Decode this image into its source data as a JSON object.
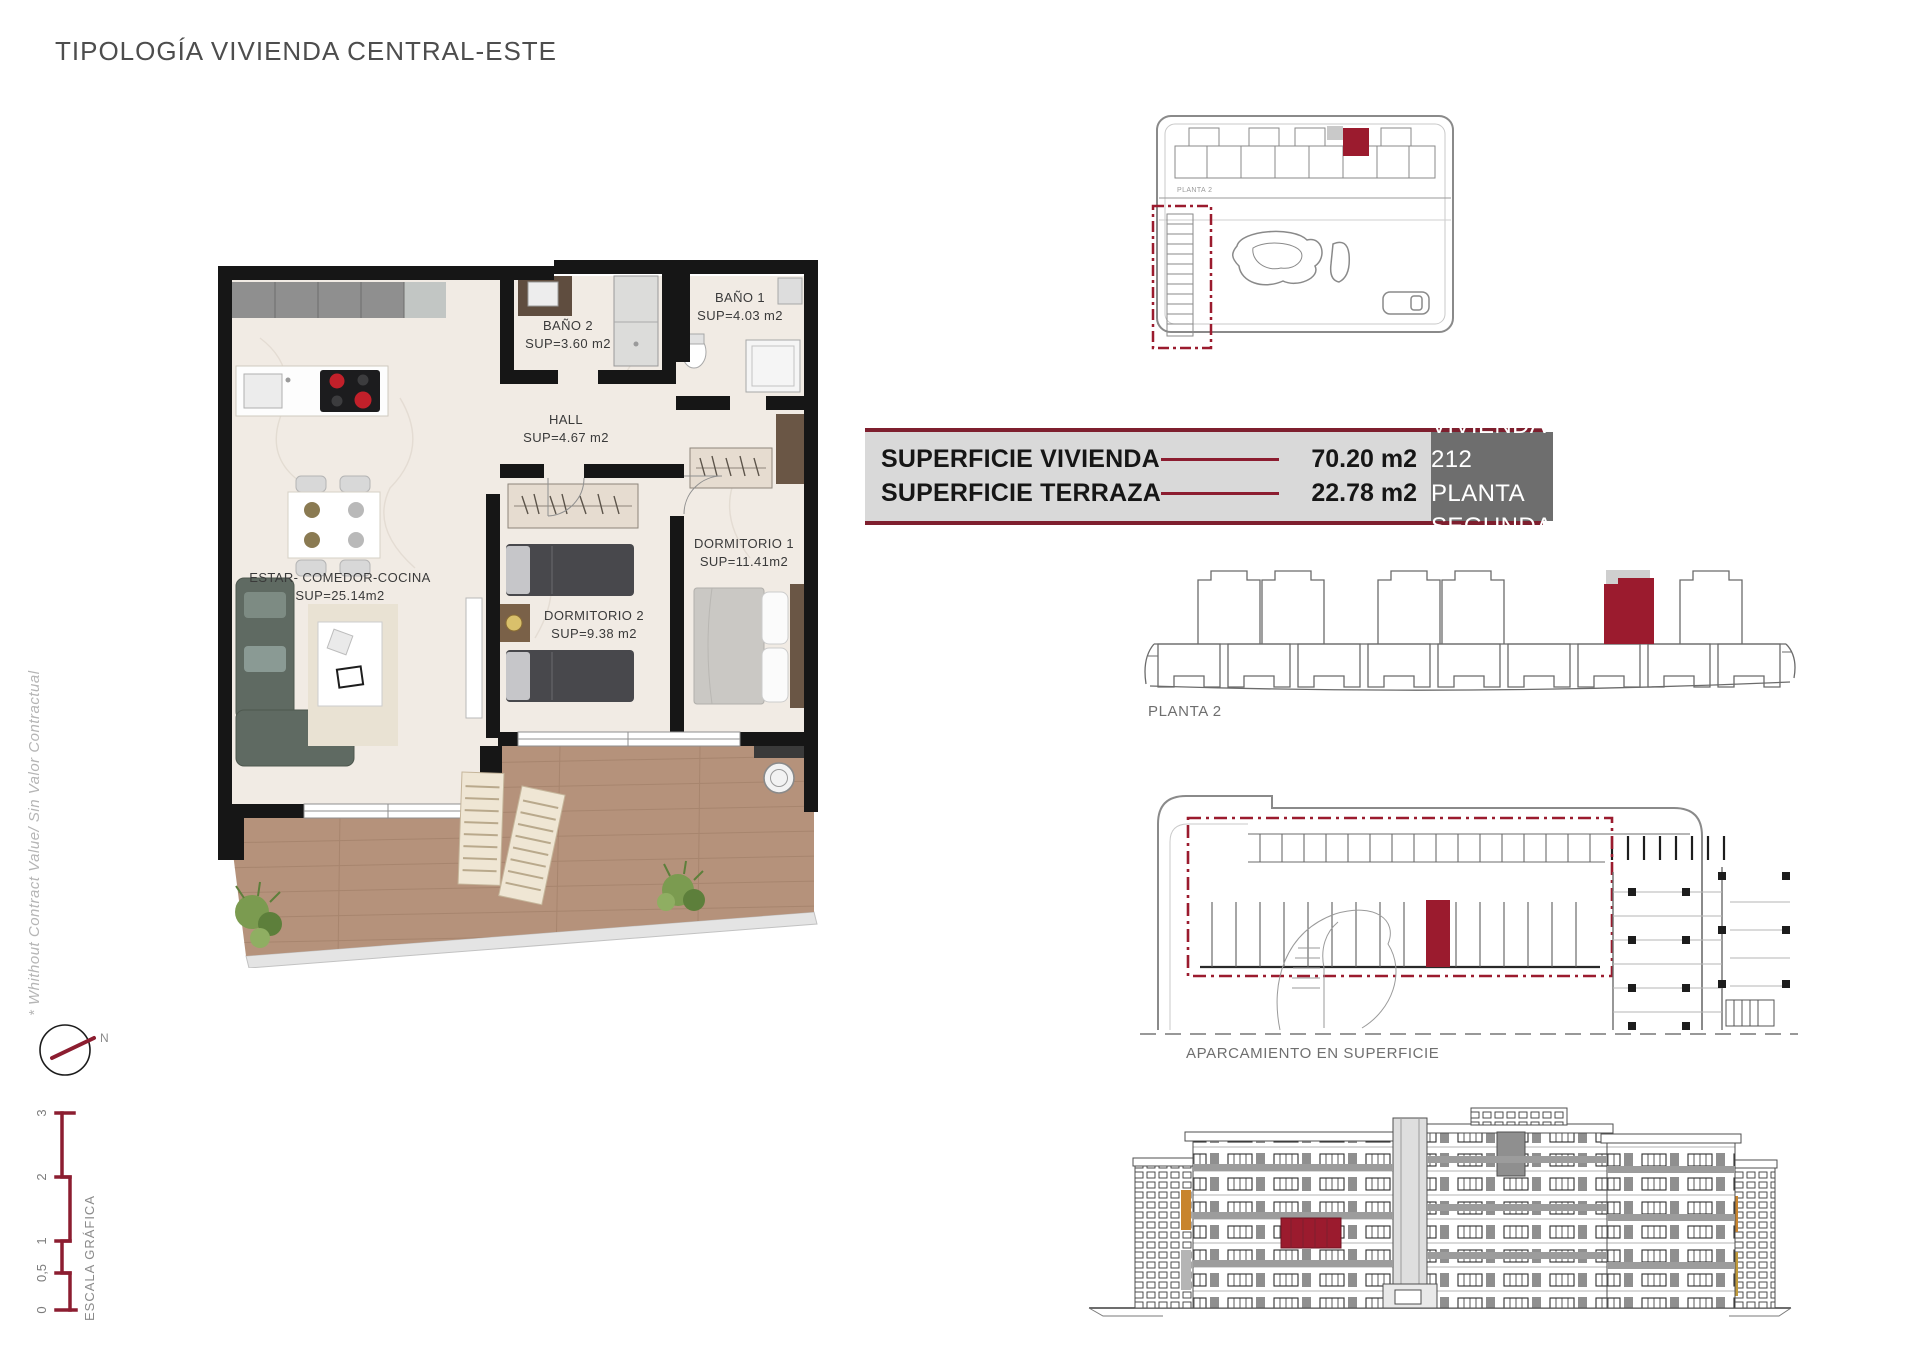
{
  "title": "TIPOLOGÍA VIVIENDA CENTRAL-ESTE",
  "side_note": "* Whithout Contract Value/ Sin Valor Contractual",
  "compass": {
    "north_label": "N"
  },
  "scale_bar": {
    "label": "ESCALA GRÁFICA",
    "ticks": [
      "0",
      "0,5",
      "1",
      "2",
      "3"
    ]
  },
  "floor_plan": {
    "rooms": {
      "bano2": {
        "name": "BAÑO 2",
        "area": "SUP=3.60 m2"
      },
      "bano1": {
        "name": "BAÑO 1",
        "area": "SUP=4.03 m2"
      },
      "hall": {
        "name": "HALL",
        "area": "SUP=4.67 m2"
      },
      "dormitorio1": {
        "name": "DORMITORIO 1",
        "area": "SUP=11.41m2"
      },
      "dormitorio2": {
        "name": "DORMITORIO 2",
        "area": "SUP=9.38 m2"
      },
      "estar": {
        "name": "ESTAR-  COMEDOR-COCINA",
        "area": "SUP=25.14m2"
      }
    }
  },
  "summary": {
    "rows": [
      {
        "label": "SUPERFICIE VIVIENDA",
        "value": "70.20 m2"
      },
      {
        "label": "SUPERFICIE TERRAZA",
        "value": "22.78 m2"
      }
    ],
    "unit_line1": "VIVIENDA 212",
    "unit_line2": "PLANTA SEGUNDA"
  },
  "diagrams": {
    "site_plan_label": "PLANTA 2",
    "floor_key_label": "PLANTA 2",
    "parking_label": "APARCAMIENTO EN SUPERFICIE"
  },
  "colors": {
    "accent_red": "#9b1b2e",
    "table_border_red": "#7e1f2e",
    "table_bg": "#d9d9d9",
    "unit_cell_bg": "#6e6e6e",
    "title_gray": "#4d4d4d"
  }
}
